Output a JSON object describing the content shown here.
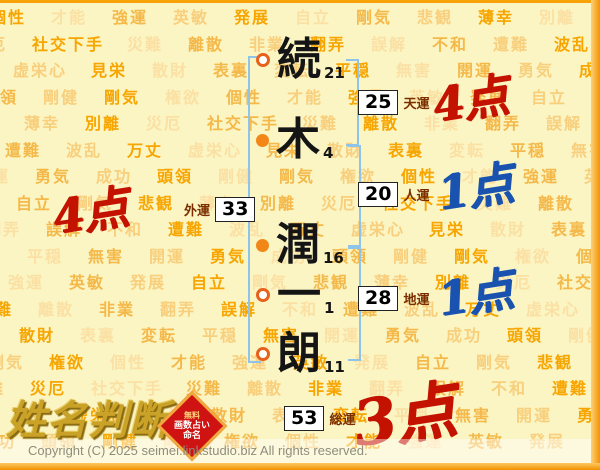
{
  "name": {
    "characters": [
      {
        "char": "続",
        "strokes": "21",
        "marker": "open"
      },
      {
        "char": "木",
        "strokes": "4",
        "marker": "filled"
      },
      {
        "char": "潤",
        "strokes": "16",
        "marker": "filled"
      },
      {
        "char": "一",
        "strokes": "1",
        "marker": "open"
      },
      {
        "char": "朗",
        "strokes": "11",
        "marker": "open"
      }
    ]
  },
  "luck": {
    "tenun": {
      "label": "天運",
      "value": "25",
      "score": "4点",
      "score_color": "red"
    },
    "jinun": {
      "label": "人運",
      "value": "20",
      "score": "1点",
      "score_color": "blue"
    },
    "chiun": {
      "label": "地運",
      "value": "28",
      "score": "1点",
      "score_color": "blue"
    },
    "gaiun": {
      "label": "外運",
      "value": "33",
      "score": "4点",
      "score_color": "red"
    },
    "souun": {
      "label": "総運",
      "value": "53",
      "score": "3点",
      "score_color": "red"
    }
  },
  "branding": {
    "logo_text": "姓名判断",
    "badge": {
      "line1": "無料",
      "line2": "画数占い",
      "line3": "命名"
    }
  },
  "footer": {
    "copyright": "Copyright (C) 2025 seimei.linkstudio.biz All rights reserved."
  },
  "background": {
    "words": [
      "個性",
      "才能",
      "強運",
      "英敏",
      "発展",
      "自立",
      "剛気",
      "悲観",
      "薄幸",
      "別離",
      "災厄",
      "社交下手",
      "災難",
      "離散",
      "非業",
      "翻弄",
      "誤解",
      "不和",
      "遭難",
      "波乱",
      "万丈",
      "虚栄心",
      "見栄",
      "散財",
      "表裏",
      "変転",
      "平穏",
      "無害",
      "開運",
      "勇気",
      "成功",
      "頭領",
      "剛健",
      "剛気",
      "権欲"
    ],
    "word_colors": [
      "#f7a500",
      "#f8cf7d",
      "#f4b94a",
      "#fbe0a4"
    ]
  },
  "colors": {
    "background": "#fbf5c3",
    "score_red": "#c41200",
    "score_blue": "#1a52b0",
    "bracket_blue": "#8fc4ea",
    "label_maroon": "#7a2e00",
    "border_orange": "#f7a206",
    "logo_gold": "#c9a227",
    "marker_orange": "#f28718"
  }
}
